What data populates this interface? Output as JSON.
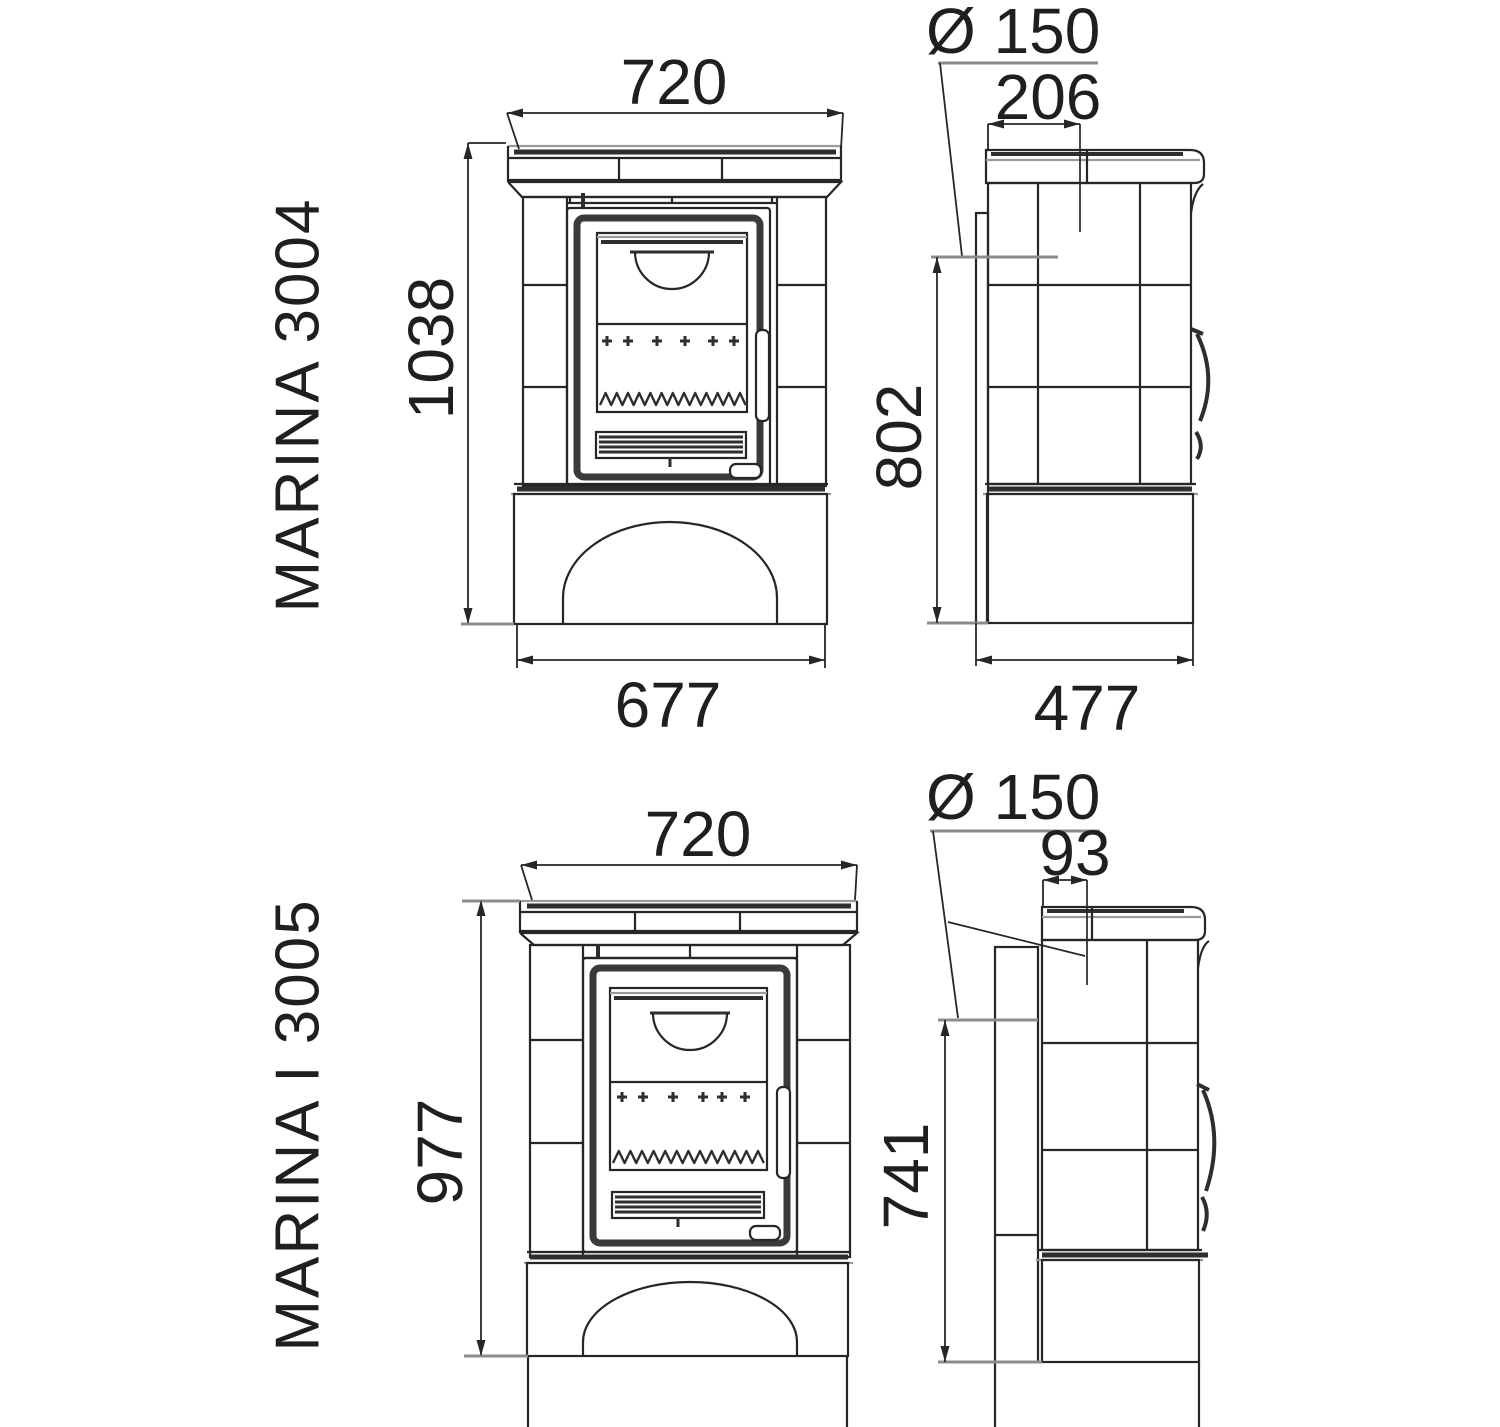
{
  "colors": {
    "line": "#262626",
    "background": "#ffffff"
  },
  "models": [
    {
      "name": "MARINA 3004",
      "front": {
        "top_width": "720",
        "height": "1038",
        "base_width": "677"
      },
      "side": {
        "flue_diameter": "Ø 150",
        "flue_top_offset": "206",
        "flue_rear_height": "802",
        "depth": "477"
      }
    },
    {
      "name": "MARINA I 3005",
      "front": {
        "top_width": "720",
        "height": "977"
      },
      "side": {
        "flue_diameter": "Ø 150",
        "flue_top_offset": "93",
        "flue_rear_height": "741"
      }
    }
  ]
}
